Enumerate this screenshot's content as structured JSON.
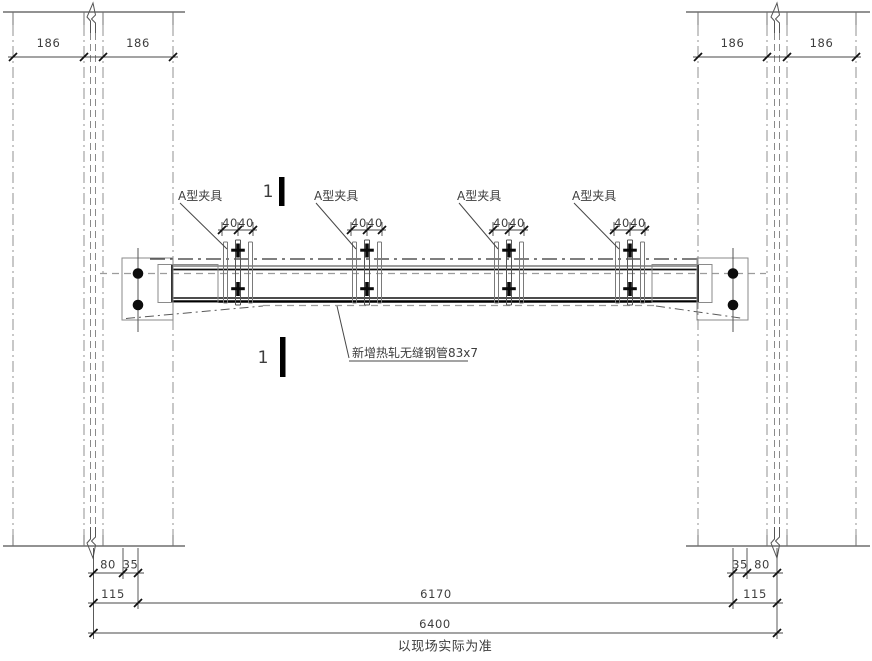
{
  "drawing": {
    "clamp_label": "A型夹具",
    "section_marker": "1",
    "pipe_label": "新增热轧无缝钢管83x7",
    "caption": "以现场实际为准",
    "dims": {
      "top_left": [
        "186",
        "186"
      ],
      "top_right": [
        "186",
        "186"
      ],
      "clamp_spacing": [
        "40",
        "40"
      ],
      "bottom_left": [
        "80",
        "35",
        "115"
      ],
      "bottom_right": [
        "35",
        "80",
        "115"
      ],
      "inner_span": "6170",
      "total_span": "6400"
    }
  }
}
